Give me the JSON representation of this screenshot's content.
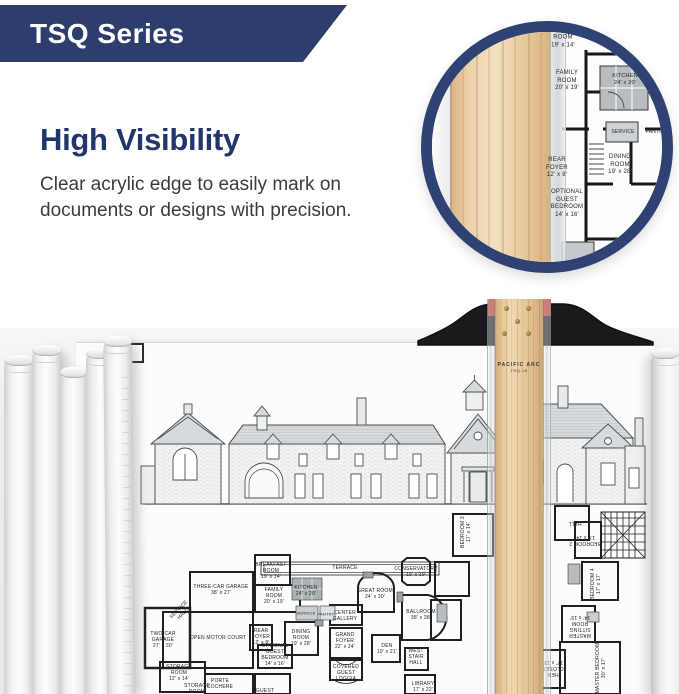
{
  "banner": {
    "label": "TSQ Series",
    "bg": "#2d3d6c",
    "text_color": "#ffffff"
  },
  "feature": {
    "title": "High Visibility",
    "title_color": "#21366b",
    "description": "Clear acrylic edge to easily mark on documents or designs with precision.",
    "text_color": "#3c3c3c"
  },
  "inset": {
    "border_color": "#2e4374",
    "labels": [
      "ROOM\n19' x 14'",
      "FAMILY\nROOM\n20' x 19'",
      "KITCHEN\n24' x 20'",
      "SERVICE",
      "PANTRY",
      "REAR\nFOYER\n12' x 8'",
      "DINING\nROOM\n19' x 28'",
      "OPTIONAL\nGUEST\nBEDROOM\n14' x 16'"
    ]
  },
  "tsquare": {
    "brand": "PACIFIC ARC",
    "model": "TSQ-18",
    "head_color": "#1a1a1c",
    "accent_red": "#c5372b",
    "wood_color": "#e6c697"
  },
  "plan": {
    "labels": [
      "TERRACE",
      "BREAKFAST\nROOM\n19' x 14'",
      "FAMILY\nROOM\n20' x 19'",
      "KITCHEN\n24' x 20'",
      "SERVICE",
      "PANTRY",
      "REAR\nFOYER\n12' x 8'",
      "CENTER\nGALLERY",
      "DINING\nROOM\n19' x 28'",
      "GRAND\nFOYER\n22' x 24'",
      "GREAT ROOM\n24' x 30'",
      "THREE-CAR GARAGE\n38' x 27'",
      "OPEN MOTOR COURT",
      "TWO-CAR\nGARAGE\n27' x 30'",
      "SERVICE\nHALL",
      "STORAGE\nROOM\n12' x 14'",
      "STORAGE\nROOM",
      "PORTE\nCOCHERE",
      "OPTIONAL\nGUEST\nBEDROOM\n14' x 16'",
      "COVERED\nGUEST\nLOGGIA",
      "DEN\n19' x 21'",
      "GUEST",
      "CONSERVATORY\n19' x 19'",
      "BALLROOM\n38' x 38'",
      "WEST\nSTAIR\nHALL",
      "LIBRARY\n17' x 22'",
      "BEDROOM 3\n17' x 14'",
      "HALL",
      "BEDROOM 2\n17' x 14'",
      "BEDROOM 4\n17' x 17'",
      "MASTER\nSITTING\nROOM\n14' x 19'",
      "MASTER BEDROOM\n30' x 17'",
      "HER\nCLOSET\n17' x 13'"
    ]
  }
}
